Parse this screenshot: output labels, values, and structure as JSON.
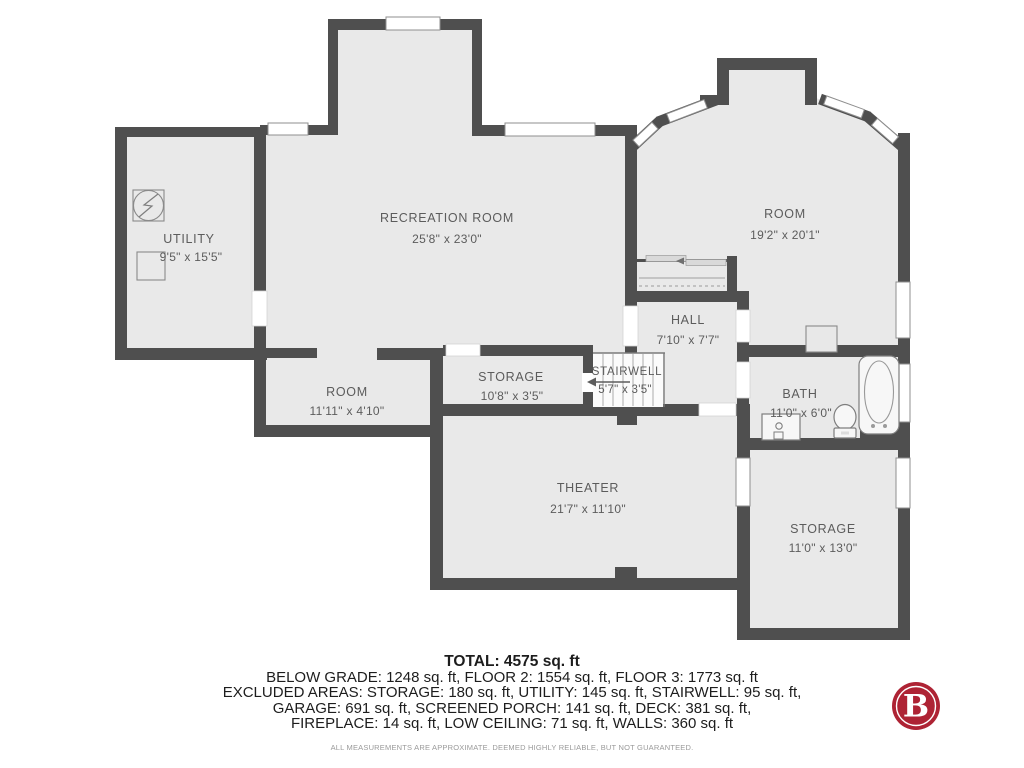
{
  "summary": {
    "total": "TOTAL: 4575 sq. ft",
    "line1": "BELOW GRADE: 1248 sq. ft, FLOOR 2: 1554 sq. ft, FLOOR 3: 1773 sq. ft",
    "line2": "EXCLUDED AREAS: STORAGE: 180 sq. ft, UTILITY: 145 sq. ft, STAIRWELL: 95 sq. ft,",
    "line3": "GARAGE: 691 sq. ft, SCREENED PORCH: 141 sq. ft, DECK: 381 sq. ft,",
    "line4": "FIREPLACE: 14 sq. ft, LOW CEILING: 71 sq. ft, WALLS: 360 sq. ft",
    "disclaimer": "ALL MEASUREMENTS ARE APPROXIMATE. DEEMED HIGHLY RELIABLE, BUT NOT GUARANTEED."
  },
  "rooms": {
    "utility": {
      "name": "UTILITY",
      "dims": "9'5\" x 15'5\""
    },
    "recreation": {
      "name": "RECREATION ROOM",
      "dims": "25'8\" x 23'0\""
    },
    "room_upper": {
      "name": "ROOM",
      "dims": "19'2\" x 20'1\""
    },
    "hall": {
      "name": "HALL",
      "dims": "7'10\" x 7'7\""
    },
    "stairwell": {
      "name": "STAIRWELL",
      "dims": "5'7\" x 3'5\""
    },
    "room_lower": {
      "name": "ROOM",
      "dims": "11'11\" x 4'10\""
    },
    "storage_small": {
      "name": "STORAGE",
      "dims": "10'8\" x 3'5\""
    },
    "bath": {
      "name": "BATH",
      "dims": "11'0\" x 6'0\""
    },
    "theater": {
      "name": "THEATER",
      "dims": "21'7\" x 11'10\""
    },
    "storage_large": {
      "name": "STORAGE",
      "dims": "11'0\" x 13'0\""
    }
  },
  "logo": {
    "letter": "B"
  },
  "colors": {
    "wall": "#4F4F4F",
    "floor": "#E9E9E9",
    "label": "#5C5C5C",
    "logo_red": "#AE2334"
  }
}
